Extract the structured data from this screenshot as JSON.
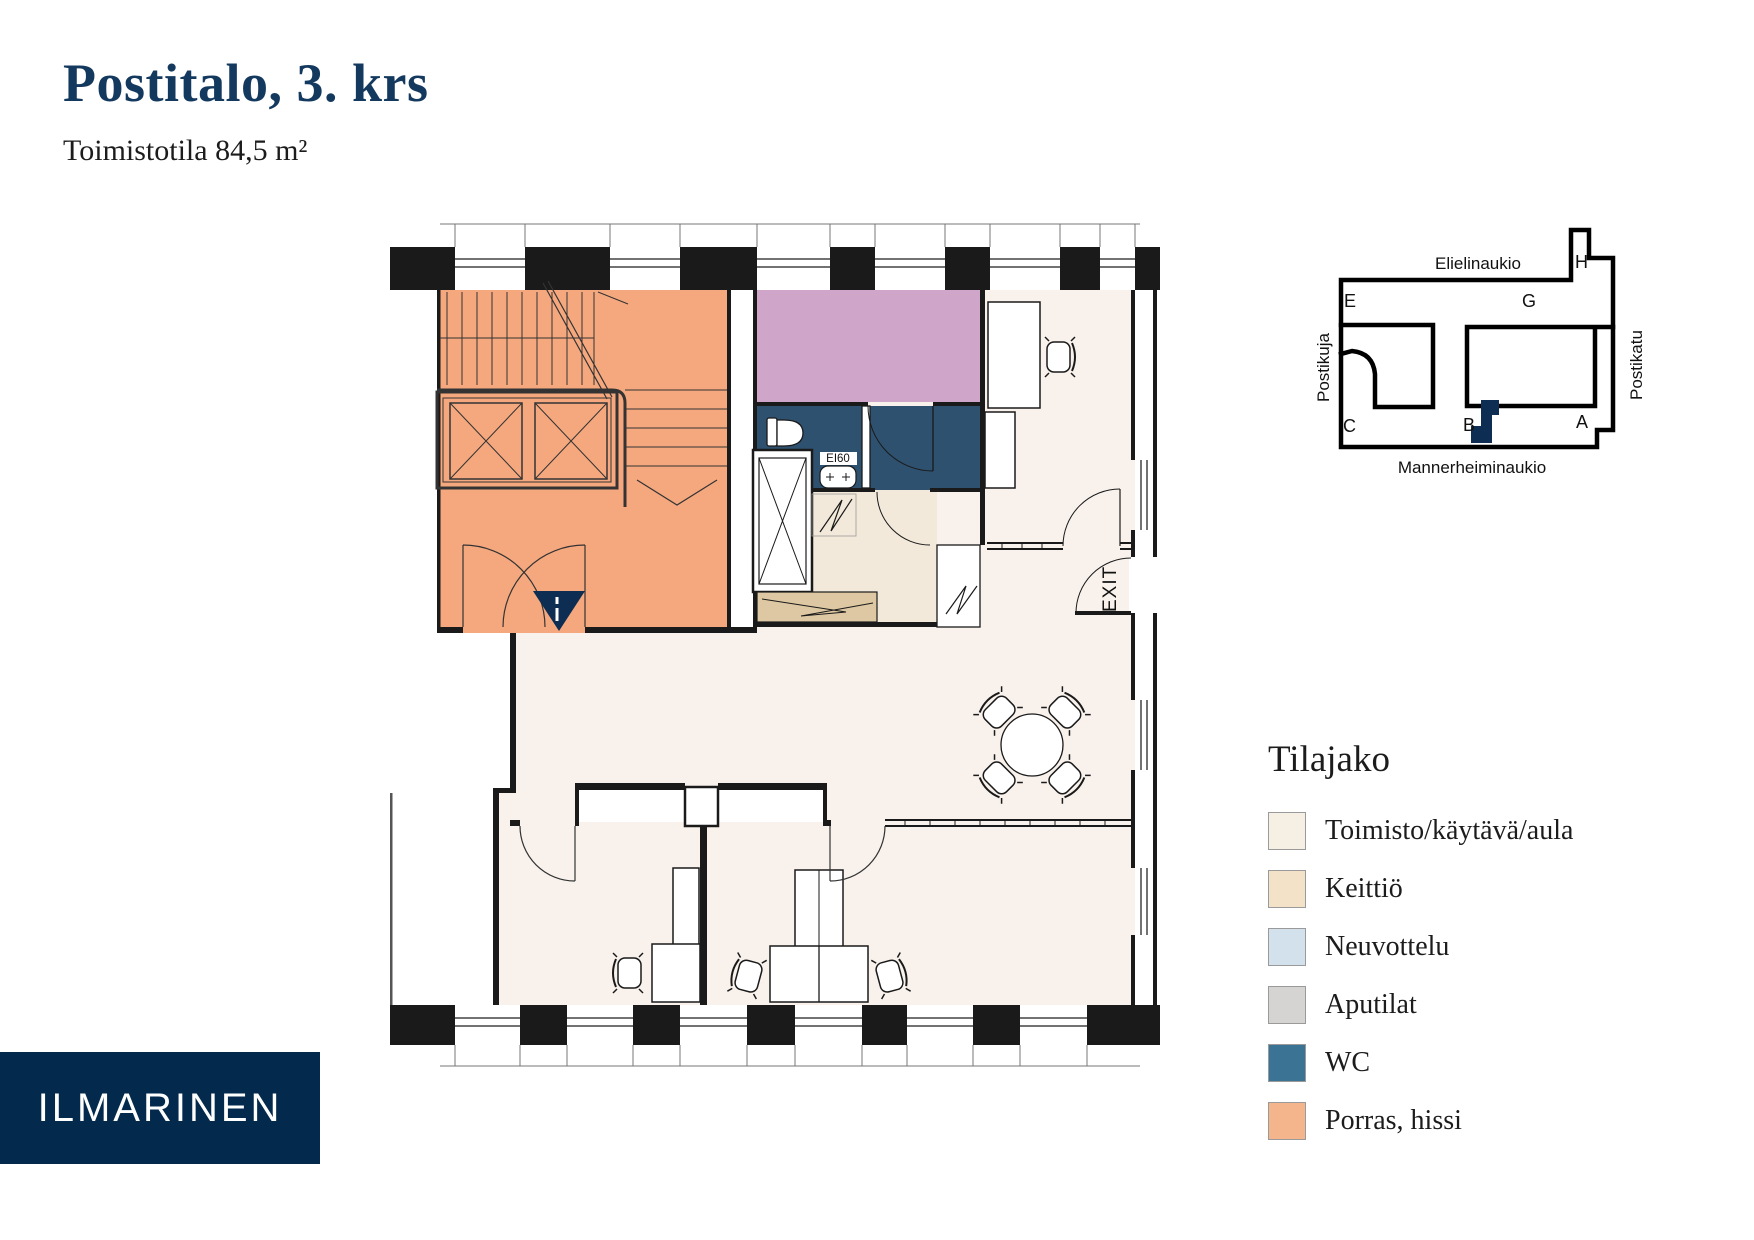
{
  "header": {
    "title": "Postitalo, 3. krs",
    "subtitle": "Toimistotila 84,5 m²"
  },
  "plan": {
    "exit_label": "EXIT",
    "fire_label": "EI60"
  },
  "site_map": {
    "street_top": "Elielinaukio",
    "street_left": "Postikuja",
    "street_right": "Postikatu",
    "street_bottom": "Mannerheiminaukio",
    "entrance_e": "E",
    "entrance_g": "G",
    "entrance_h": "H",
    "entrance_c": "C",
    "entrance_b": "B",
    "entrance_a": "A",
    "marker_color": "#0d2d52"
  },
  "legend": {
    "title": "Tilajako",
    "items": [
      {
        "label": "Toimisto/käytävä/aula",
        "color": "#f6efe3"
      },
      {
        "label": "Keittiö",
        "color": "#f3e1c8"
      },
      {
        "label": "Neuvottelu",
        "color": "#d2e1ec"
      },
      {
        "label": "Aputilat",
        "color": "#d6d4d2"
      },
      {
        "label": "WC",
        "color": "#3a7394"
      },
      {
        "label": "Porras, hissi",
        "color": "#f4b48c"
      }
    ]
  },
  "logo": {
    "text": "ILMARINEN",
    "bg_color": "#032a4d"
  },
  "colors": {
    "title_navy": "#14395f",
    "plan_floor": "#f9f2ec",
    "plan_orange": "#f5a87e",
    "plan_purple": "#cfa5ca",
    "plan_wc": "#2e516f",
    "plan_kitchen_floor": "#f3e9da",
    "plan_counter": "#ddc8a3",
    "marker_navy": "#0d2d52"
  }
}
